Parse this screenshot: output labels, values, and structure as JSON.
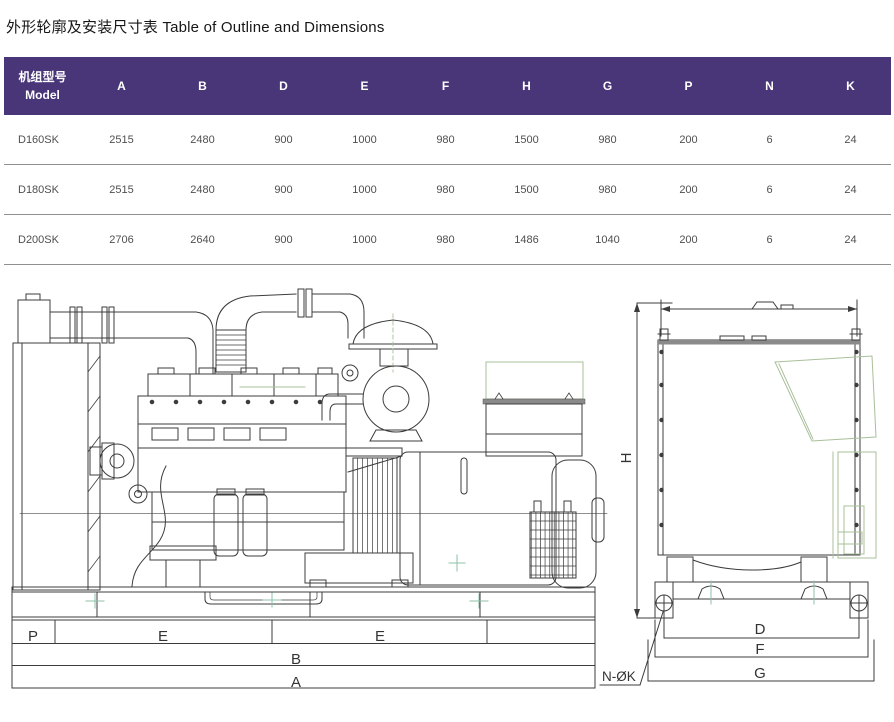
{
  "title": "外形轮廓及安装尺寸表 Table of Outline and Dimensions",
  "table": {
    "model_header_line1": "机组型号",
    "model_header_line2": "Model",
    "columns": [
      "A",
      "B",
      "D",
      "E",
      "F",
      "H",
      "G",
      "P",
      "N",
      "K"
    ],
    "rows": [
      {
        "model": "D160SK",
        "values": [
          "2515",
          "2480",
          "900",
          "1000",
          "980",
          "1500",
          "980",
          "200",
          "6",
          "24"
        ]
      },
      {
        "model": "D180SK",
        "values": [
          "2515",
          "2480",
          "900",
          "1000",
          "980",
          "1500",
          "980",
          "200",
          "6",
          "24"
        ]
      },
      {
        "model": "D200SK",
        "values": [
          "2706",
          "2640",
          "900",
          "1000",
          "980",
          "1486",
          "1040",
          "200",
          "6",
          "24"
        ]
      }
    ]
  },
  "drawing": {
    "side_view": {
      "p": "P",
      "e1": "E",
      "e2": "E",
      "b": "B",
      "a": "A"
    },
    "end_view": {
      "h": "H",
      "d": "D",
      "f": "F",
      "g": "G",
      "bolt_callout": "N-ØK"
    }
  },
  "colors": {
    "header_bg": "#483678",
    "header_text": "#ffffff",
    "drawing_line": "#3c3c3c",
    "drawing_accent_green": "#a9bf9a",
    "row_text": "#4f4f4f"
  }
}
